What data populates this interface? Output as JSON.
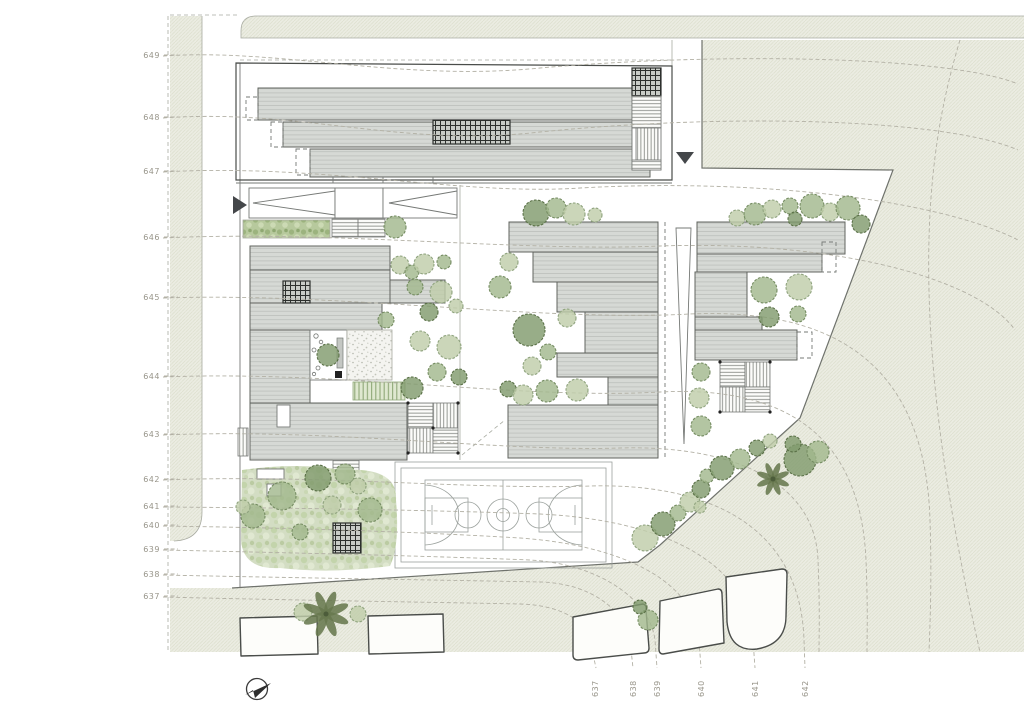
{
  "drawing": {
    "kind": "architectural-site-plan",
    "features": [
      "terraced roof buildings",
      "basketball court",
      "gardens",
      "existing structures",
      "topographic contours"
    ]
  },
  "elevation_labels_left": [
    {
      "value": "649",
      "x": 160,
      "y": 58
    },
    {
      "value": "648",
      "x": 160,
      "y": 120
    },
    {
      "value": "647",
      "x": 160,
      "y": 174
    },
    {
      "value": "646",
      "x": 160,
      "y": 240
    },
    {
      "value": "645",
      "x": 160,
      "y": 300
    },
    {
      "value": "644",
      "x": 160,
      "y": 379
    },
    {
      "value": "643",
      "x": 160,
      "y": 437
    },
    {
      "value": "642",
      "x": 160,
      "y": 482
    },
    {
      "value": "641",
      "x": 160,
      "y": 509
    },
    {
      "value": "640",
      "x": 160,
      "y": 528
    },
    {
      "value": "639",
      "x": 160,
      "y": 552
    },
    {
      "value": "638",
      "x": 160,
      "y": 577
    },
    {
      "value": "637",
      "x": 160,
      "y": 599
    }
  ],
  "elevation_labels_bottom": [
    {
      "value": "637",
      "x": 598,
      "y": 697
    },
    {
      "value": "638",
      "x": 636,
      "y": 697
    },
    {
      "value": "639",
      "x": 660,
      "y": 697
    },
    {
      "value": "640",
      "x": 704,
      "y": 697
    },
    {
      "value": "641",
      "x": 758,
      "y": 697
    },
    {
      "value": "642",
      "x": 808,
      "y": 697
    }
  ],
  "markers": {
    "north_arrow": "north-arrow",
    "entrance_left": "triangle-right",
    "entrance_top": "triangle-down"
  },
  "compass": {
    "x": 257,
    "y": 689
  },
  "colors": {
    "paper": "#ffffff",
    "terrain_fill": "#ebece2",
    "terrain_hatch": "#dcdecd",
    "roof_fill": "#d6d9d5",
    "roof_stripe": "#bcc0bc",
    "outline_dark": "#4a4d4a",
    "outline_mid": "#767976",
    "contour": "#b3b1a5",
    "label": "#98958a",
    "garden": "#cfdabe",
    "tree_light": "#bfcdaa",
    "tree_mid": "#a2b88e",
    "tree_dark": "#819b6e",
    "pergola_grid": "#2d302d"
  },
  "trees": [
    [
      395,
      227,
      11,
      "M"
    ],
    [
      536,
      213,
      13,
      "D"
    ],
    [
      556,
      208,
      10,
      "M"
    ],
    [
      574,
      214,
      11,
      "L"
    ],
    [
      595,
      215,
      7,
      "L"
    ],
    [
      400,
      265,
      9,
      "L"
    ],
    [
      412,
      272,
      7,
      "M"
    ],
    [
      424,
      264,
      10,
      "L"
    ],
    [
      444,
      262,
      7,
      "M"
    ],
    [
      415,
      287,
      8,
      "M"
    ],
    [
      441,
      292,
      11,
      "L"
    ],
    [
      429,
      312,
      9,
      "D"
    ],
    [
      456,
      306,
      7,
      "L"
    ],
    [
      420,
      341,
      10,
      "L"
    ],
    [
      449,
      347,
      12,
      "L"
    ],
    [
      437,
      372,
      9,
      "M"
    ],
    [
      459,
      377,
      8,
      "D"
    ],
    [
      412,
      388,
      11,
      "D"
    ],
    [
      386,
      320,
      8,
      "M"
    ],
    [
      328,
      355,
      11,
      "D"
    ],
    [
      509,
      262,
      9,
      "L"
    ],
    [
      500,
      287,
      11,
      "M"
    ],
    [
      529,
      330,
      16,
      "D"
    ],
    [
      548,
      352,
      8,
      "M"
    ],
    [
      567,
      318,
      9,
      "L"
    ],
    [
      508,
      389,
      8,
      "D"
    ],
    [
      523,
      395,
      10,
      "L"
    ],
    [
      547,
      391,
      11,
      "M"
    ],
    [
      577,
      390,
      11,
      "L"
    ],
    [
      532,
      366,
      9,
      "L"
    ],
    [
      737,
      218,
      8,
      "L"
    ],
    [
      755,
      214,
      11,
      "M"
    ],
    [
      772,
      209,
      9,
      "L"
    ],
    [
      790,
      206,
      8,
      "M"
    ],
    [
      812,
      206,
      12,
      "M"
    ],
    [
      830,
      212,
      9,
      "L"
    ],
    [
      848,
      208,
      12,
      "M"
    ],
    [
      861,
      224,
      9,
      "D"
    ],
    [
      795,
      219,
      7,
      "D"
    ],
    [
      764,
      290,
      13,
      "M"
    ],
    [
      799,
      287,
      13,
      "L"
    ],
    [
      769,
      317,
      10,
      "D"
    ],
    [
      798,
      314,
      8,
      "M"
    ],
    [
      701,
      372,
      9,
      "M"
    ],
    [
      699,
      398,
      10,
      "L"
    ],
    [
      701,
      426,
      10,
      "M"
    ],
    [
      645,
      538,
      13,
      "L"
    ],
    [
      663,
      524,
      12,
      "D"
    ],
    [
      678,
      513,
      8,
      "M"
    ],
    [
      690,
      502,
      10,
      "L"
    ],
    [
      701,
      489,
      9,
      "D"
    ],
    [
      707,
      476,
      7,
      "M"
    ],
    [
      722,
      468,
      12,
      "D"
    ],
    [
      740,
      459,
      10,
      "M"
    ],
    [
      757,
      448,
      8,
      "D"
    ],
    [
      770,
      441,
      7,
      "L"
    ],
    [
      700,
      507,
      6,
      "L"
    ],
    [
      800,
      460,
      16,
      "D"
    ],
    [
      818,
      452,
      11,
      "M"
    ],
    [
      793,
      444,
      8,
      "D"
    ],
    [
      318,
      478,
      13,
      "D"
    ],
    [
      345,
      474,
      10,
      "M"
    ],
    [
      358,
      486,
      8,
      "L"
    ],
    [
      282,
      496,
      14,
      "M"
    ],
    [
      253,
      516,
      12,
      "M"
    ],
    [
      243,
      507,
      7,
      "L"
    ],
    [
      370,
      510,
      12,
      "M"
    ],
    [
      332,
      505,
      9,
      "L"
    ],
    [
      300,
      532,
      8,
      "M"
    ],
    [
      303,
      612,
      9,
      "L"
    ],
    [
      358,
      614,
      8,
      "L"
    ],
    [
      648,
      620,
      10,
      "M"
    ],
    [
      640,
      607,
      7,
      "D"
    ]
  ],
  "palms": [
    {
      "x": 326,
      "y": 614,
      "r": 21
    },
    {
      "x": 773,
      "y": 479,
      "r": 15
    }
  ]
}
